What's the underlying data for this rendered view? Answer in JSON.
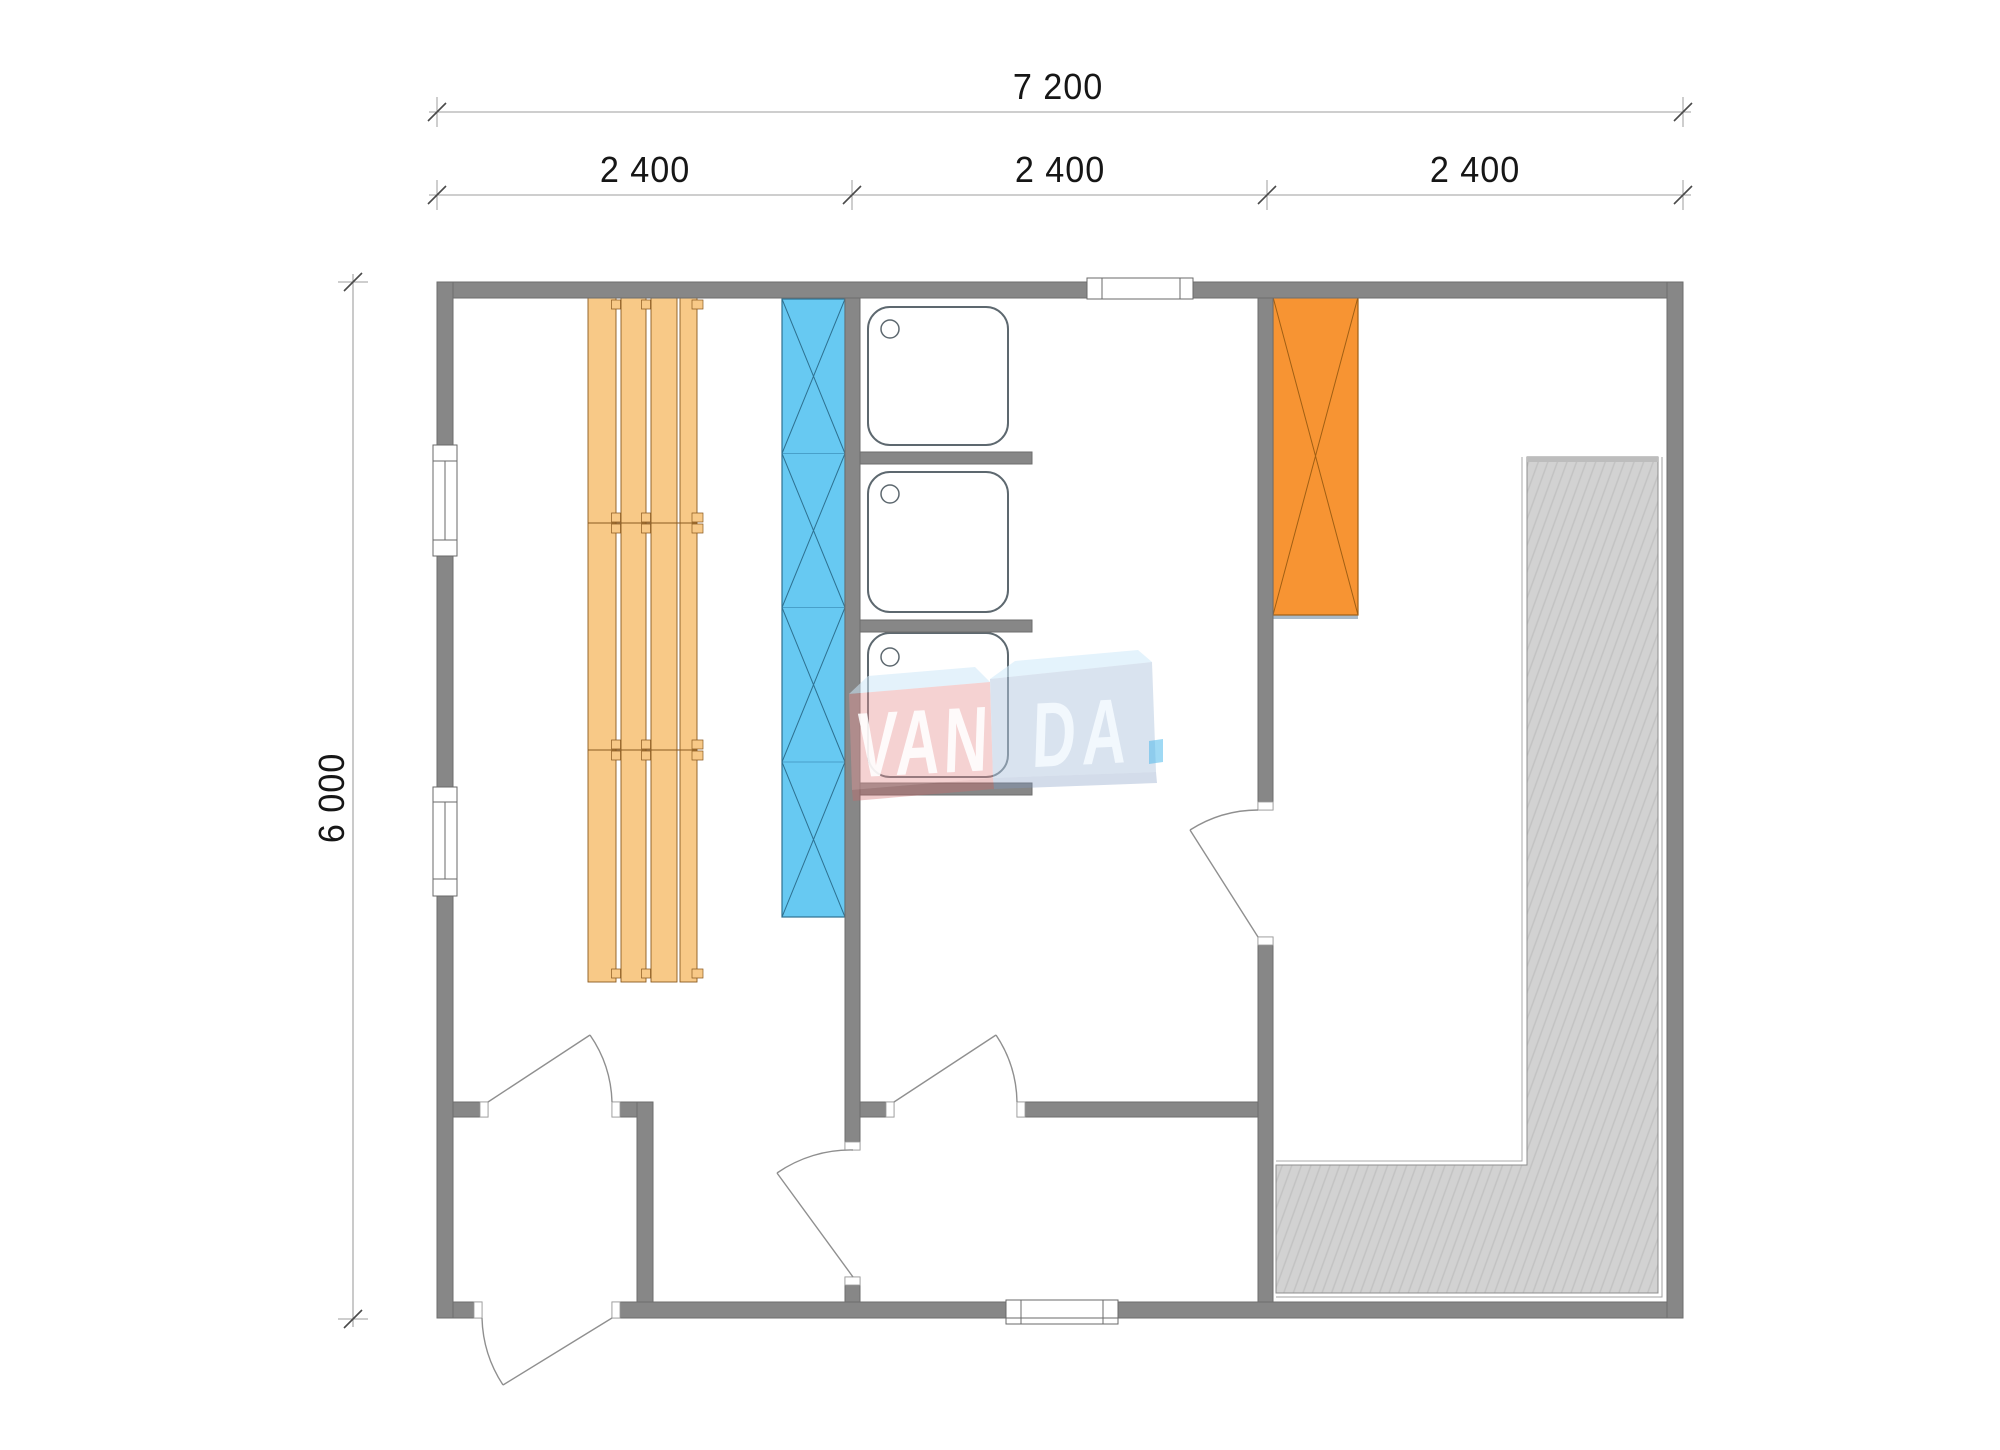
{
  "page_title": "VANDA sauna cabin floor plan",
  "dimensions": {
    "overall_width": "7 200",
    "bays": [
      "2 400",
      "2 400",
      "2 400"
    ],
    "overall_depth": "6 000"
  },
  "watermark": {
    "text": "VANDA",
    "left_part": "VAN",
    "right_part": "DA"
  },
  "plan_contents": {
    "fixtures": [
      "sauna-benches",
      "sauna-heater",
      "shower-tray-1",
      "shower-tray-2",
      "shower-tray-3",
      "wood-stove",
      "terrace-deck"
    ],
    "openings": [
      "left-wall-window-upper",
      "left-wall-window-lower",
      "top-wall-window",
      "bottom-wall-window",
      "entrance-door",
      "vestibule-sauna-door",
      "shower-room-door",
      "changing-room-door",
      "terrace-room-door"
    ]
  },
  "colors": {
    "wall_gray": "#878787",
    "bench_wood": "#f8c987",
    "heater_blue": "#67c9f2",
    "stove_orange": "#f79433",
    "terrace_gray": "#d2d2d2",
    "dimension_text": "#161616",
    "watermark_pink": "#e79494",
    "watermark_blue": "#b4c7e0"
  }
}
